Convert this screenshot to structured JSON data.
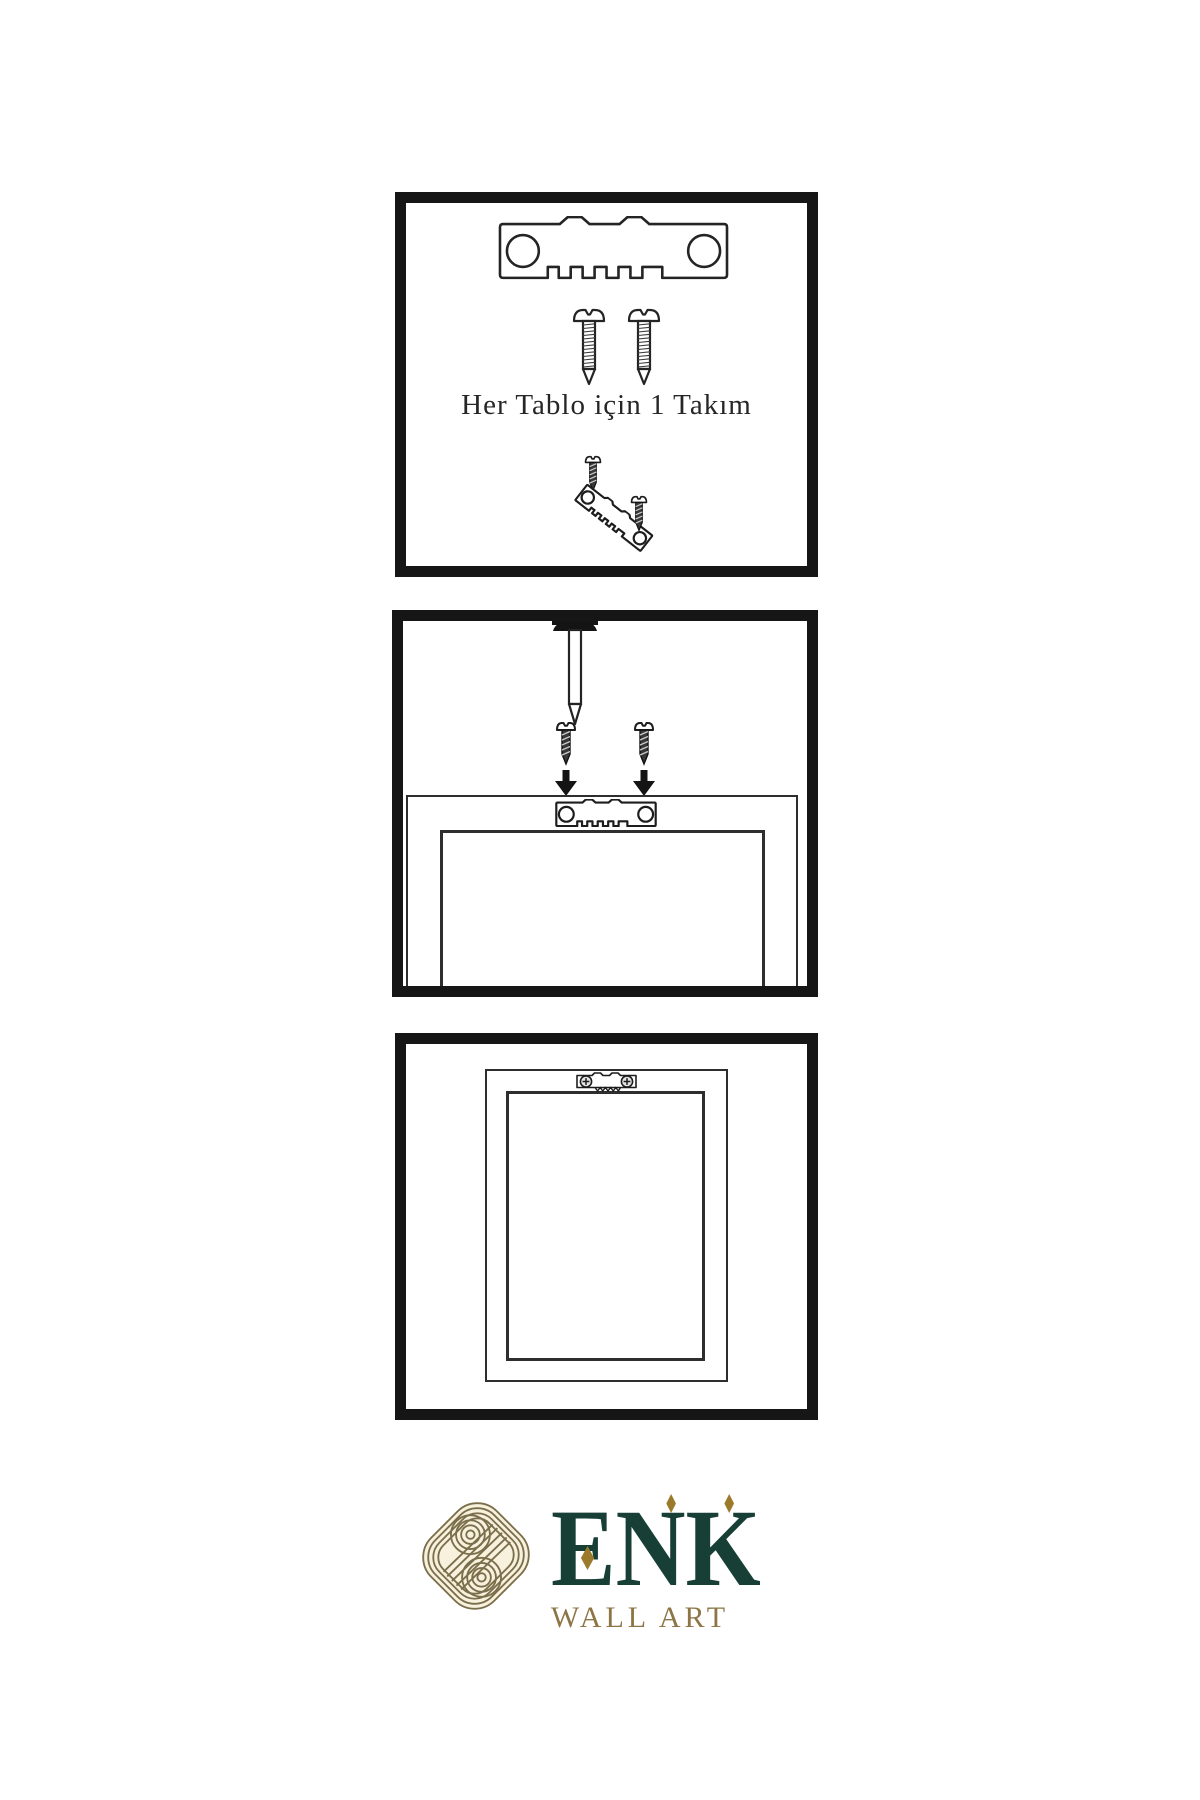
{
  "page": {
    "background": "#ffffff",
    "line_color": "#242424",
    "panel_border_color": "#161616",
    "type": "wall-art-hanging-instructions"
  },
  "step1": {
    "caption": "Her Tablo için 1 Takım",
    "items": [
      "sawtooth-hanger",
      "screw",
      "screw",
      "screw-driving",
      "sawtooth-hanger-tilted",
      "screw-driving"
    ]
  },
  "step2": {
    "items": [
      "wall-nail",
      "dark-screw-left",
      "dark-screw-right",
      "arrow-down-left",
      "arrow-down-right",
      "frame-back-outer",
      "frame-back-inner",
      "sawtooth-hanger-mounted"
    ]
  },
  "step3": {
    "items": [
      "frame-front-outer",
      "frame-front-inner",
      "sawtooth-hanger-installed-with-screws"
    ]
  },
  "brand": {
    "name": "ENK",
    "tagline": "WALL ART",
    "name_color": "#173f35",
    "tagline_color": "#8e7546",
    "accent_color": "#9b7a2c",
    "knot_color": "#7b6f4b",
    "knot_background": "#f7f1de"
  }
}
